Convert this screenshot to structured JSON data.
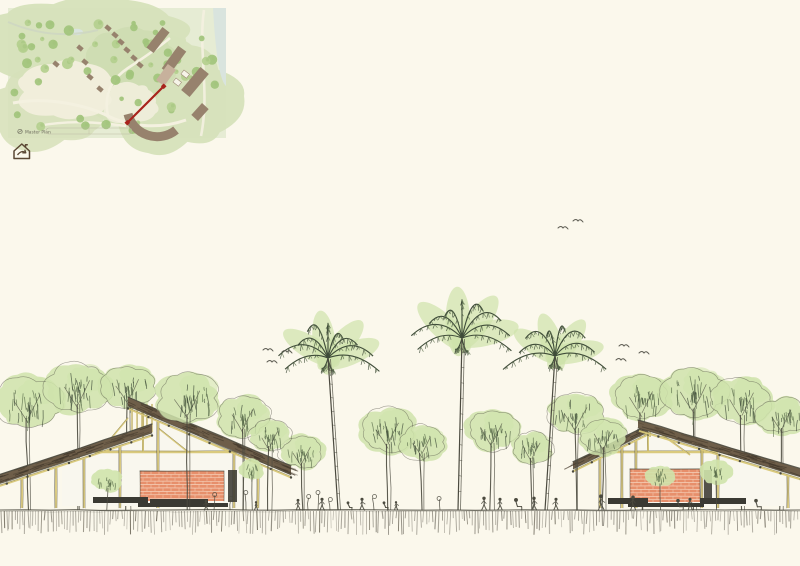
{
  "page": {
    "width": 800,
    "height": 566,
    "background": "#fbf8ec",
    "description": "Hand-drawn architectural site elevation sketch with inset master plan map"
  },
  "palette": {
    "paper": "#fbf8ec",
    "ink": "#4b4a3f",
    "tree_wash": "#cfe3ab",
    "tree_line": "#5b6e4c",
    "tree_line_dark": "#3f4c39",
    "roof_fill": "#6e5e49",
    "roof_hatch": "#43392c",
    "structure_yellow": "#d9c878",
    "wall_white": "#f9f7ee",
    "brick": "#e78f6b",
    "brick_joint": "#f7d9c4",
    "plinth": "#3b3a33",
    "ground": "#8f8b80",
    "ground_dark": "#6a6557",
    "bird": "#5d5c52"
  },
  "site_plan": {
    "label": "Master Plan",
    "frame": {
      "x": 8,
      "y": 8,
      "w": 218,
      "h": 130
    },
    "colors": {
      "base": "#e6ecd4",
      "grass": "#d6e1ba",
      "grass_dark": "#c8d8aa",
      "meadow": "#f1eedb",
      "path": "#f4f1e0",
      "water": "#d9e4de",
      "stream": "#cdd6c2",
      "tree_a": "#b4cf8e",
      "tree_b": "#a2c47c",
      "building": "#97826d",
      "building_light": "#c7b19c",
      "section_line": "#a8231c",
      "label_ink": "#6d6c5d",
      "bar_line": "#b9b5a0"
    },
    "cabins": [
      [
        100,
        20
      ],
      [
        107,
        27
      ],
      [
        113,
        34
      ],
      [
        119,
        42
      ],
      [
        126,
        50
      ],
      [
        132,
        57
      ],
      [
        72,
        40
      ],
      [
        77,
        54
      ],
      [
        82,
        69
      ],
      [
        92,
        81
      ],
      [
        48,
        56
      ]
    ],
    "large_buildings": [
      {
        "x": 150,
        "y": 32,
        "w": 9,
        "h": 26,
        "rot": 38,
        "light": false
      },
      {
        "x": 166,
        "y": 52,
        "w": 10,
        "h": 28,
        "rot": 36,
        "light": false
      },
      {
        "x": 187,
        "y": 74,
        "w": 11,
        "h": 30,
        "rot": 40,
        "light": false
      },
      {
        "x": 192,
        "y": 104,
        "w": 9,
        "h": 16,
        "rot": 42,
        "light": false
      },
      {
        "x": 158,
        "y": 67,
        "w": 10,
        "h": 20,
        "rot": 36,
        "light": true
      }
    ],
    "white_buildings": [
      [
        168,
        70
      ],
      [
        176,
        62
      ]
    ],
    "curved_building": {
      "cx": 150,
      "cy": 96,
      "r": 30,
      "w": 9
    },
    "section_line": {
      "x1": 120,
      "y1": 114,
      "x2": 155,
      "y2": 79
    },
    "tree_count": 58,
    "pond": {
      "cx": 69,
      "cy": 24,
      "rx": 6,
      "ry": 3.2
    },
    "scale_bar": {
      "x": 38,
      "y": 120,
      "w": 86,
      "h": 6
    }
  },
  "logo": {
    "name": "house-arrow-logo",
    "x": 12,
    "y": 141,
    "color": "#5a4733"
  },
  "elevation": {
    "ground": {
      "y": 510,
      "x1": 0,
      "x2": 800,
      "hatch_min": 7,
      "hatch_max": 24
    },
    "buildings": [
      {
        "name": "left-pavilion",
        "roofs": [
          {
            "p1": [
              128,
              397
            ],
            "p2": [
              291,
              466
            ],
            "th": 9
          },
          {
            "p1": [
              152,
              424
            ],
            "p2": [
              -14,
              479
            ],
            "th": 9
          }
        ],
        "clerestory": {
          "x1": 132,
          "x2": 152,
          "y1": 404,
          "y2": 432
        },
        "wall_poly": [
          [
            62,
            464
          ],
          [
            150,
            434
          ],
          [
            150,
            416
          ],
          [
            260,
            462
          ],
          [
            260,
            506
          ],
          [
            62,
            506
          ]
        ],
        "beam_y": 452,
        "kingpost": {
          "x": 143,
          "y1": 412,
          "y2": 452
        },
        "struts": [
          [
            100,
            452,
            128,
            418
          ],
          [
            188,
            452,
            158,
            428
          ]
        ],
        "posts": [
          22,
          56,
          84,
          120,
          158,
          234,
          258
        ],
        "brick": {
          "x": 140,
          "y": 471,
          "w": 84,
          "h": 30
        },
        "door": {
          "x": 228,
          "y": 470,
          "w": 9,
          "h": 32
        },
        "plinths": [
          [
            93,
            497,
            55,
            6
          ],
          [
            150,
            499,
            58,
            6
          ],
          [
            138,
            503,
            90,
            4
          ]
        ]
      },
      {
        "name": "right-pavilion",
        "roofs": [
          {
            "p1": [
              648,
              425
            ],
            "p2": [
              573,
              462
            ],
            "th": 7
          },
          {
            "p1": [
              638,
              420
            ],
            "p2": [
              801,
              469
            ],
            "th": 8
          }
        ],
        "clerestory": {
          "x1": 640,
          "x2": 654,
          "y1": 423,
          "y2": 437
        },
        "wall_poly": [
          [
            622,
            446
          ],
          [
            646,
            433
          ],
          [
            646,
            431
          ],
          [
            790,
            474
          ],
          [
            790,
            506
          ],
          [
            622,
            506
          ]
        ],
        "beam_y": 452,
        "kingpost": {
          "x": 648,
          "y1": 432,
          "y2": 452
        },
        "struts": [
          [
            612,
            452,
            636,
            432
          ],
          [
            690,
            455,
            662,
            435
          ]
        ],
        "posts": [
          600,
          622,
          636,
          702,
          718,
          788
        ],
        "brick": {
          "x": 630,
          "y": 469,
          "w": 70,
          "h": 33
        },
        "door": {
          "x": 704,
          "y": 470,
          "w": 8,
          "h": 30
        },
        "plinths": [
          [
            608,
            498,
            40,
            6
          ],
          [
            700,
            498,
            46,
            6
          ],
          [
            628,
            503,
            76,
            4
          ]
        ]
      }
    ],
    "palm_trees": [
      {
        "x": 338,
        "top": 358,
        "lean": -10,
        "fronds": 9,
        "spread": 52
      },
      {
        "x": 458,
        "top": 338,
        "lean": 4,
        "fronds": 9,
        "spread": 56
      },
      {
        "x": 545,
        "top": 356,
        "lean": 10,
        "fronds": 8,
        "spread": 48
      }
    ],
    "trees": [
      {
        "x": 28,
        "y": 402,
        "r": 30,
        "front": false
      },
      {
        "x": 78,
        "y": 388,
        "r": 30,
        "front": false
      },
      {
        "x": 128,
        "y": 386,
        "r": 26,
        "front": false
      },
      {
        "x": 188,
        "y": 398,
        "r": 30,
        "front": true
      },
      {
        "x": 243,
        "y": 416,
        "r": 24,
        "front": true
      },
      {
        "x": 270,
        "y": 436,
        "r": 19,
        "front": true
      },
      {
        "x": 302,
        "y": 452,
        "r": 20,
        "front": false
      },
      {
        "x": 388,
        "y": 430,
        "r": 26,
        "front": false
      },
      {
        "x": 422,
        "y": 442,
        "r": 21,
        "front": false
      },
      {
        "x": 492,
        "y": 430,
        "r": 24,
        "front": false
      },
      {
        "x": 532,
        "y": 448,
        "r": 19,
        "front": false
      },
      {
        "x": 576,
        "y": 414,
        "r": 26,
        "front": true
      },
      {
        "x": 604,
        "y": 436,
        "r": 21,
        "front": true
      },
      {
        "x": 642,
        "y": 398,
        "r": 27,
        "front": false
      },
      {
        "x": 694,
        "y": 392,
        "r": 31,
        "front": false
      },
      {
        "x": 742,
        "y": 400,
        "r": 28,
        "front": false
      },
      {
        "x": 782,
        "y": 416,
        "r": 23,
        "front": false
      }
    ],
    "shrubs": [
      {
        "x": 108,
        "y": 480,
        "r": 14
      },
      {
        "x": 252,
        "y": 470,
        "r": 12
      },
      {
        "x": 660,
        "y": 476,
        "r": 13
      },
      {
        "x": 716,
        "y": 472,
        "r": 15
      }
    ],
    "birds": [
      [
        563,
        228
      ],
      [
        578,
        221
      ],
      [
        268,
        350
      ],
      [
        287,
        352
      ],
      [
        272,
        362
      ],
      [
        624,
        346
      ],
      [
        644,
        353
      ],
      [
        621,
        360
      ]
    ],
    "people": [
      {
        "x": 206,
        "h": 10,
        "pose": "stand"
      },
      {
        "x": 256,
        "h": 9,
        "pose": "stand"
      },
      {
        "x": 298,
        "h": 11,
        "pose": "stand"
      },
      {
        "x": 322,
        "h": 12,
        "pose": "stand"
      },
      {
        "x": 348,
        "h": 10,
        "pose": "sit"
      },
      {
        "x": 362,
        "h": 12,
        "pose": "stand"
      },
      {
        "x": 384,
        "h": 10,
        "pose": "sit"
      },
      {
        "x": 396,
        "h": 9,
        "pose": "stand"
      },
      {
        "x": 484,
        "h": 13,
        "pose": "stand"
      },
      {
        "x": 500,
        "h": 12,
        "pose": "stand"
      },
      {
        "x": 516,
        "h": 14,
        "pose": "sit"
      },
      {
        "x": 534,
        "h": 13,
        "pose": "stand"
      },
      {
        "x": 556,
        "h": 12,
        "pose": "stand"
      },
      {
        "x": 601,
        "h": 15,
        "pose": "stand"
      },
      {
        "x": 633,
        "h": 14,
        "pose": "stand"
      },
      {
        "x": 678,
        "h": 13,
        "pose": "sit"
      },
      {
        "x": 690,
        "h": 12,
        "pose": "stand"
      },
      {
        "x": 756,
        "h": 13,
        "pose": "sit"
      }
    ],
    "sprouts": [
      {
        "x": 214,
        "h": 14
      },
      {
        "x": 230,
        "h": 10
      },
      {
        "x": 246,
        "h": 16
      },
      {
        "x": 308,
        "h": 12
      },
      {
        "x": 318,
        "h": 16
      },
      {
        "x": 330,
        "h": 9
      },
      {
        "x": 374,
        "h": 12
      },
      {
        "x": 440,
        "h": 10
      }
    ]
  }
}
